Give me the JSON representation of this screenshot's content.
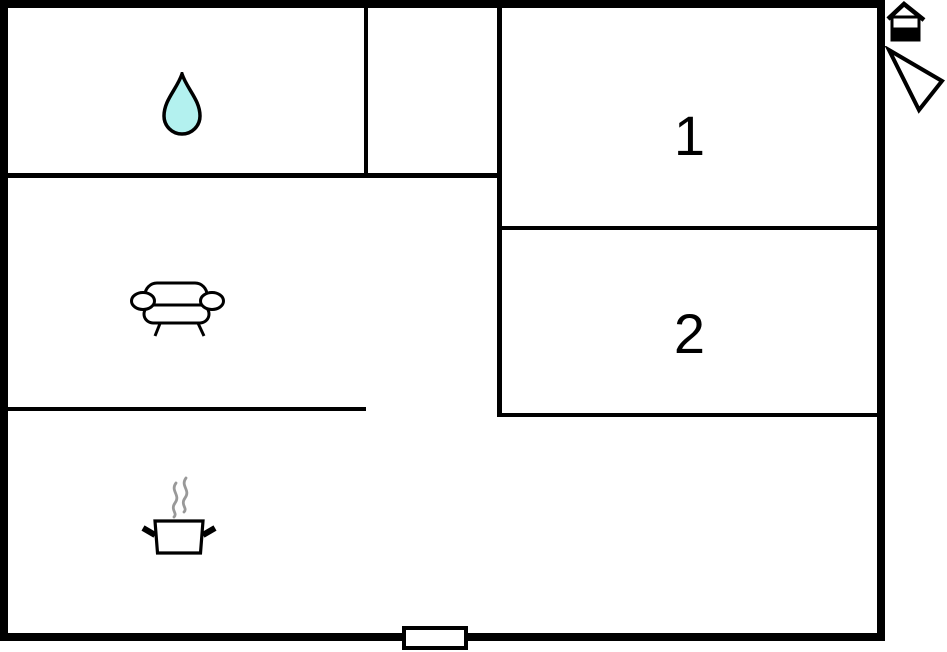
{
  "page": {
    "background_color": "#ffffff",
    "type": "floor-plan-diagram"
  },
  "floorplan": {
    "wall_color": "#000000",
    "rooms": {
      "room1": {
        "label": "1"
      },
      "room2": {
        "label": "2"
      }
    },
    "icons": {
      "water_drop": {
        "name": "water-drop-icon",
        "fill": "#b3f1ef",
        "outline": "#000000"
      },
      "sofa": {
        "name": "sofa-icon",
        "outline": "#000000",
        "fill": "#ffffff"
      },
      "cooking_pot": {
        "name": "cooking-pot-icon",
        "outline": "#000000",
        "fill": "#ffffff",
        "steam_color": "#999999"
      },
      "house": {
        "name": "house-icon",
        "color": "#000000",
        "fill": "#ffffff"
      },
      "north_arrow": {
        "name": "north-arrow-icon",
        "color": "#000000",
        "fill": "#ffffff"
      },
      "entrance": {
        "name": "entrance-door-marker",
        "outline": "#000000",
        "fill": "#ffffff"
      }
    }
  }
}
